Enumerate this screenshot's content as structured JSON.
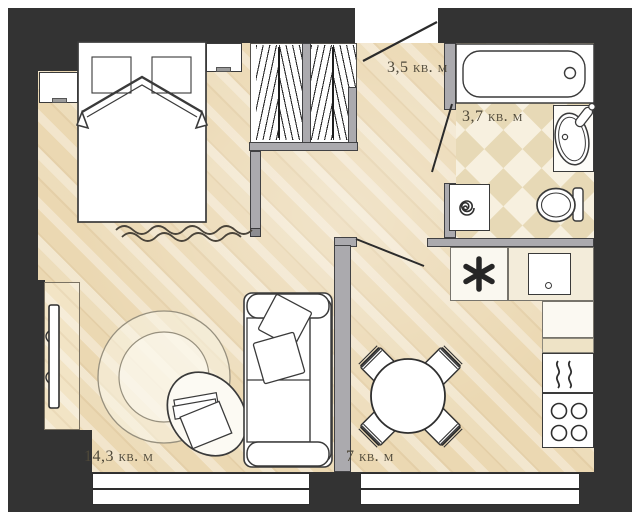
{
  "rooms": {
    "hallway": {
      "area_label": "3,5 кв. м"
    },
    "bathroom": {
      "area_label": "3,7 кв. м"
    },
    "living_room": {
      "area_label": "14,3 кв. м"
    },
    "kitchen": {
      "area_label": "7 кв. м"
    }
  },
  "colors": {
    "outer_wall": "#333333",
    "inner_wall": "#abaaae",
    "line_art": "#3a3a3a",
    "floor_wood": "#ebd8b2",
    "tile_dark": "#e7d9b6",
    "tile_light": "#f7f0df",
    "label_text": "#4e4839"
  },
  "symbols": {
    "fridge": "six-spoke-asterisk",
    "washing_machine": "spiral",
    "oven": "steam-waves",
    "stove": "four-burners"
  }
}
